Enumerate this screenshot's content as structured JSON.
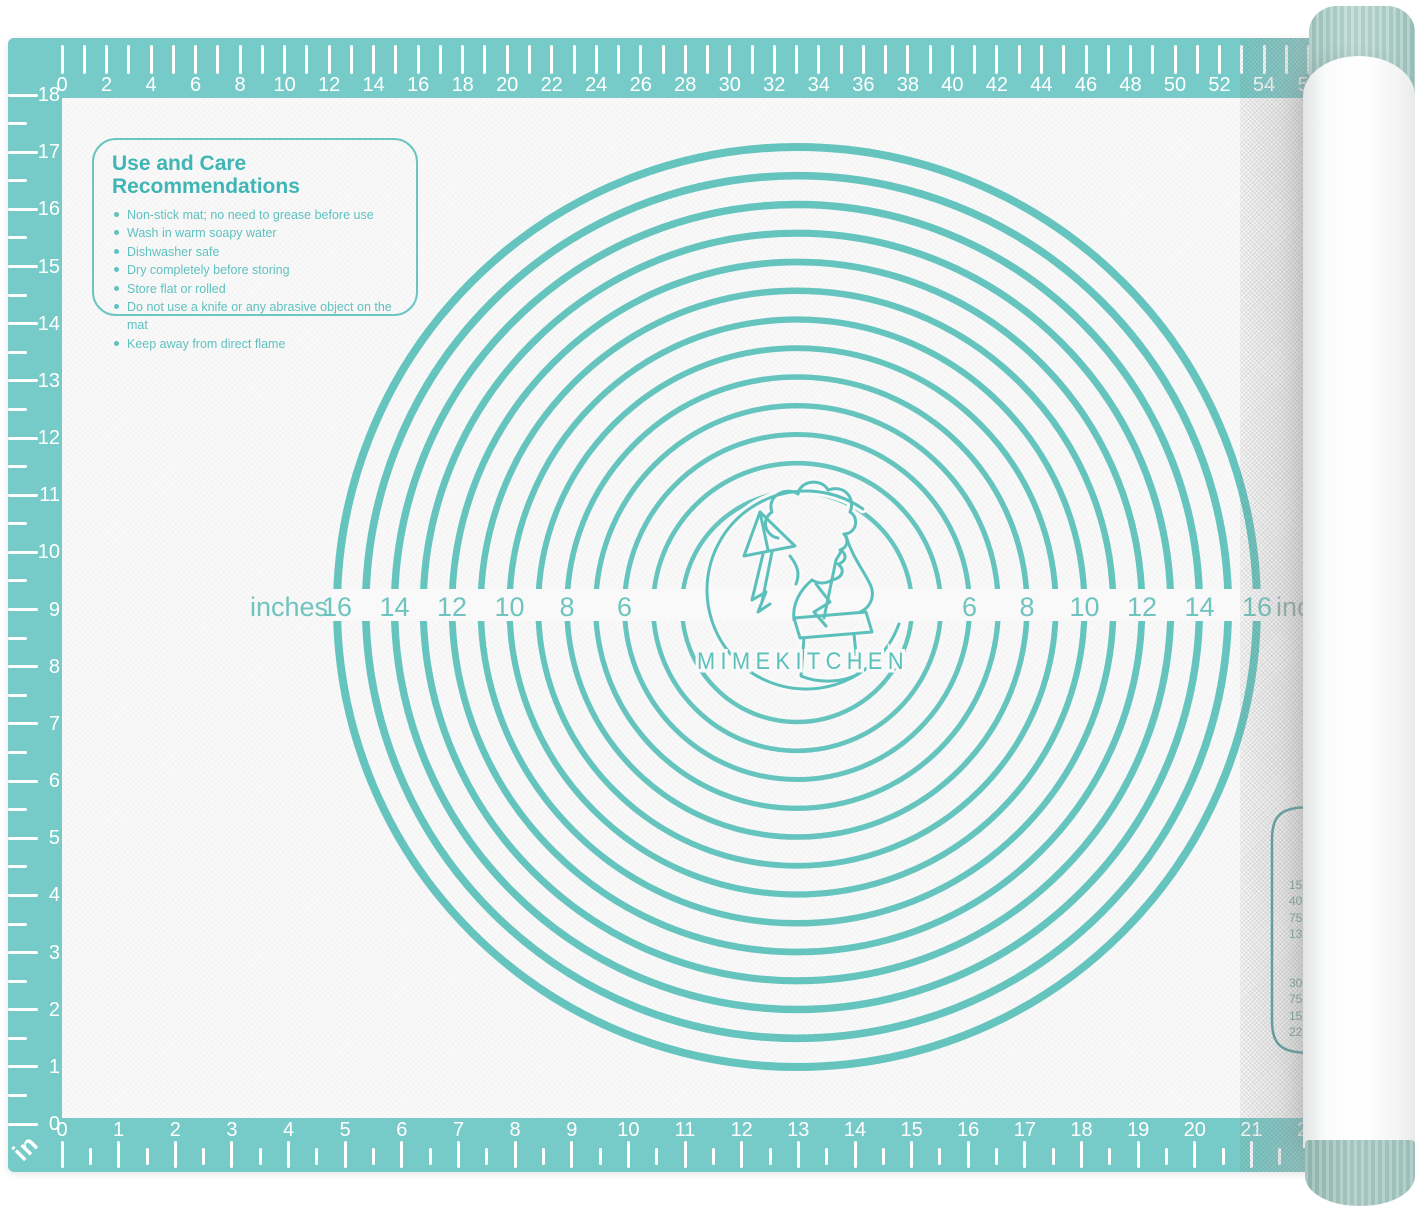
{
  "product": {
    "brand": "MIMEKITCHEN",
    "care_box": {
      "title": "Use and Care Recommendations",
      "items": [
        "Non-stick mat; no need to grease before use",
        "Wash in warm soapy water",
        "Dishwasher safe",
        "Dry completely before storing",
        "Store flat or rolled",
        "Do not use a knife or any abrasive object on the mat",
        "Keep away from direct flame"
      ]
    },
    "circle_band": {
      "left_unit": "inches",
      "right_unit": "inch",
      "left_numbers": [
        "16",
        "14",
        "12",
        "10",
        "8",
        "6"
      ],
      "right_numbers": [
        "6",
        "8",
        "10",
        "12",
        "14",
        "16"
      ],
      "circle_diameters_in": [
        4,
        5,
        6,
        7,
        8,
        9,
        10,
        11,
        12,
        13,
        14,
        15,
        16
      ]
    },
    "rulers": {
      "top_cm_labels": [
        "0",
        "2",
        "4",
        "6",
        "8",
        "10",
        "12",
        "14",
        "16",
        "18",
        "20",
        "22",
        "24",
        "26",
        "28",
        "30",
        "32",
        "34",
        "36",
        "38",
        "40",
        "42",
        "44",
        "46",
        "48",
        "50",
        "52",
        "54",
        "56"
      ],
      "bottom_in_labels": [
        "0",
        "1",
        "2",
        "3",
        "4",
        "5",
        "6",
        "7",
        "8",
        "9",
        "10",
        "11",
        "12",
        "13",
        "14",
        "15",
        "16",
        "17",
        "18",
        "19",
        "20",
        "21",
        "22"
      ],
      "left_in_labels": [
        "18",
        "17",
        "16",
        "15",
        "14",
        "13",
        "12",
        "11",
        "10",
        "9",
        "8",
        "7",
        "6",
        "5",
        "4",
        "3",
        "2",
        "1",
        "0"
      ],
      "corner_unit": "in"
    },
    "conversion_table": {
      "visible_values_group1": [
        "15",
        "40",
        "75",
        "13"
      ],
      "visible_values_group2": [
        "30",
        "75",
        "15",
        "22"
      ]
    },
    "colors": {
      "mat_teal": "#76cac7",
      "circle_teal": "#66c4bf",
      "label_teal": "#70c4bf",
      "logo_teal": "#5bc0bb",
      "care_heading": "#3fb6b5",
      "care_text": "#5fc1c0",
      "surface": "#f8f9f8",
      "ruler_text": "#ffffff",
      "faded_label": "#93aeac",
      "conversion_text": "#6fa3a2",
      "roll_cap_green": "#aecfc8"
    }
  }
}
